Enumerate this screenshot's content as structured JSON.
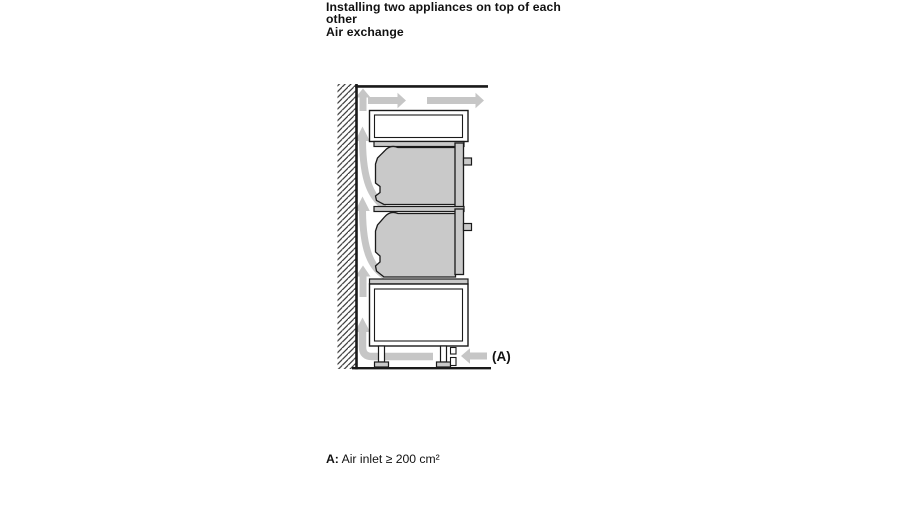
{
  "heading": {
    "title_line1": "Installing two appliances on top of each",
    "title_line2": "other",
    "subtitle": "Air exchange"
  },
  "figure": {
    "label_a": "(A)",
    "caption_term": "A:",
    "caption_text": "Air inlet ≥ 200 cm²"
  },
  "colors": {
    "line": "#1a1a1a",
    "appliance_fill": "#c9c9c9",
    "airflow_arrow": "#c6c6c6",
    "background": "#ffffff",
    "text": "#111111"
  }
}
